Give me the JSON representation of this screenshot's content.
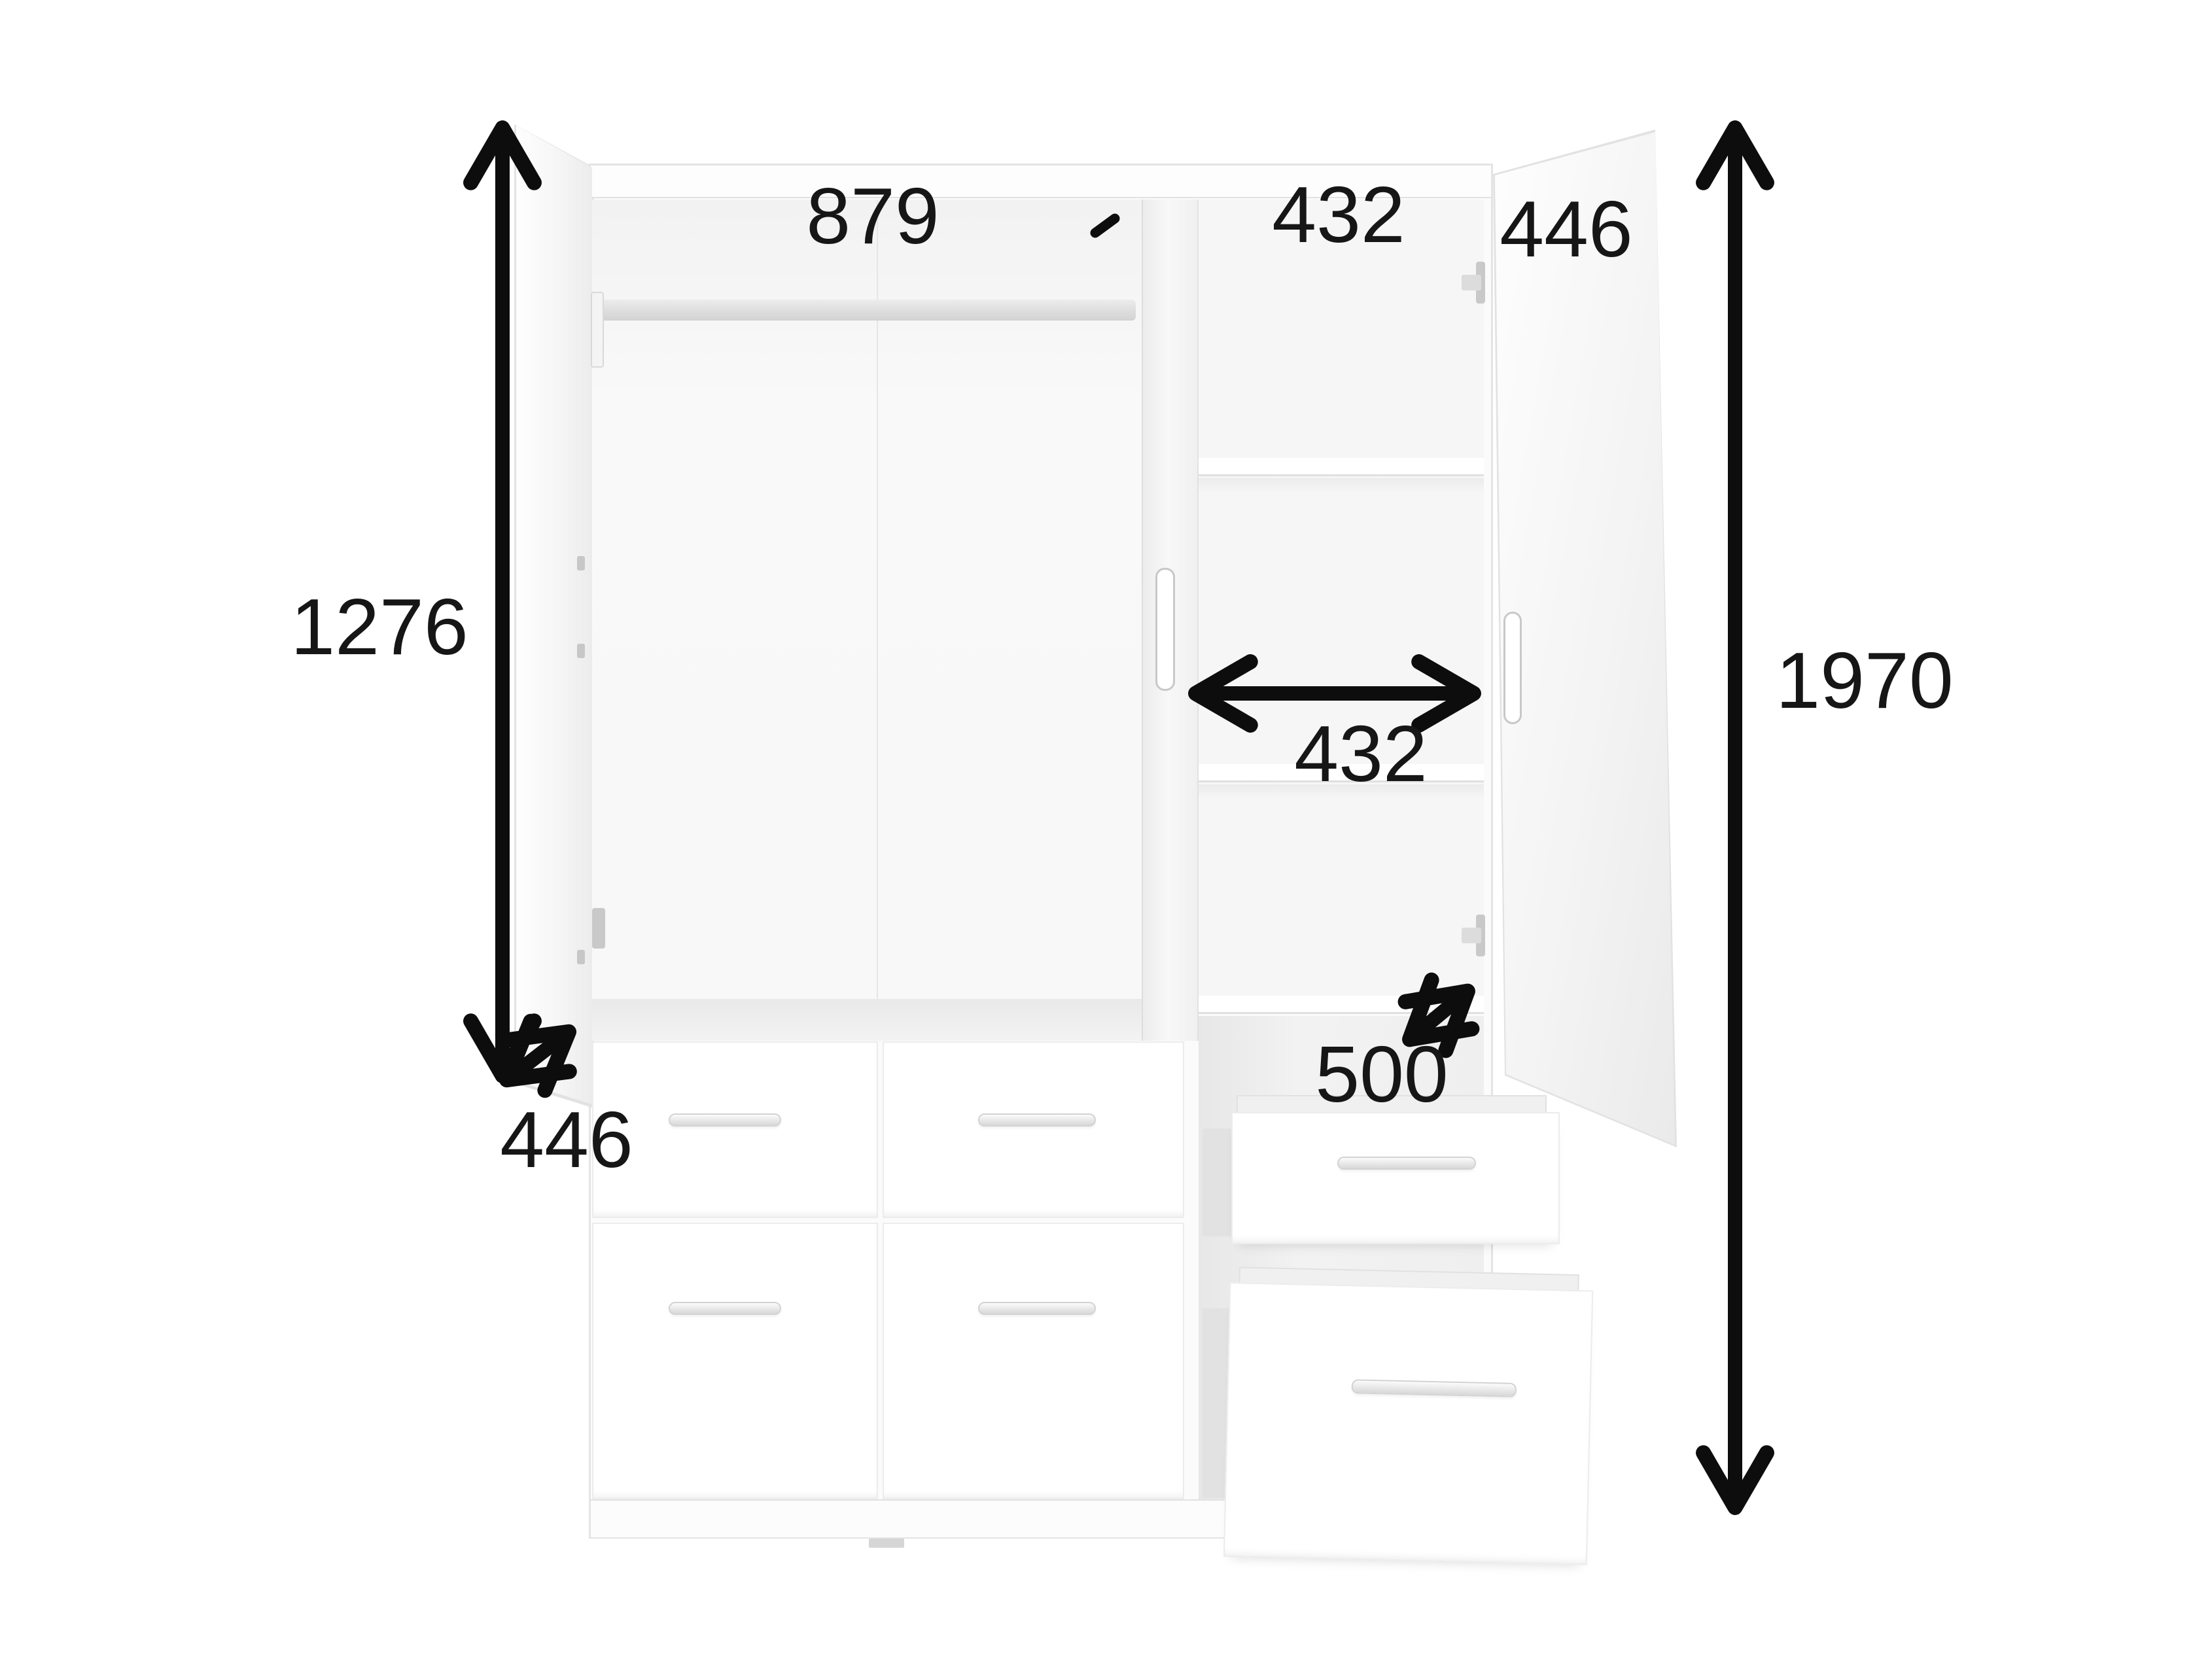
{
  "diagram": {
    "type": "wardrobe dimension diagram",
    "arrow_color": "#0d0d0d",
    "label_color": "#161616",
    "labels": {
      "interior_width": "879",
      "top_shelf_width": "432",
      "top_door_depth": "446",
      "left_interior_height": "1276",
      "middle_shelf_width": "432",
      "overall_height": "1970",
      "bottom_left_depth": "446",
      "drawer_depth": "500"
    }
  }
}
